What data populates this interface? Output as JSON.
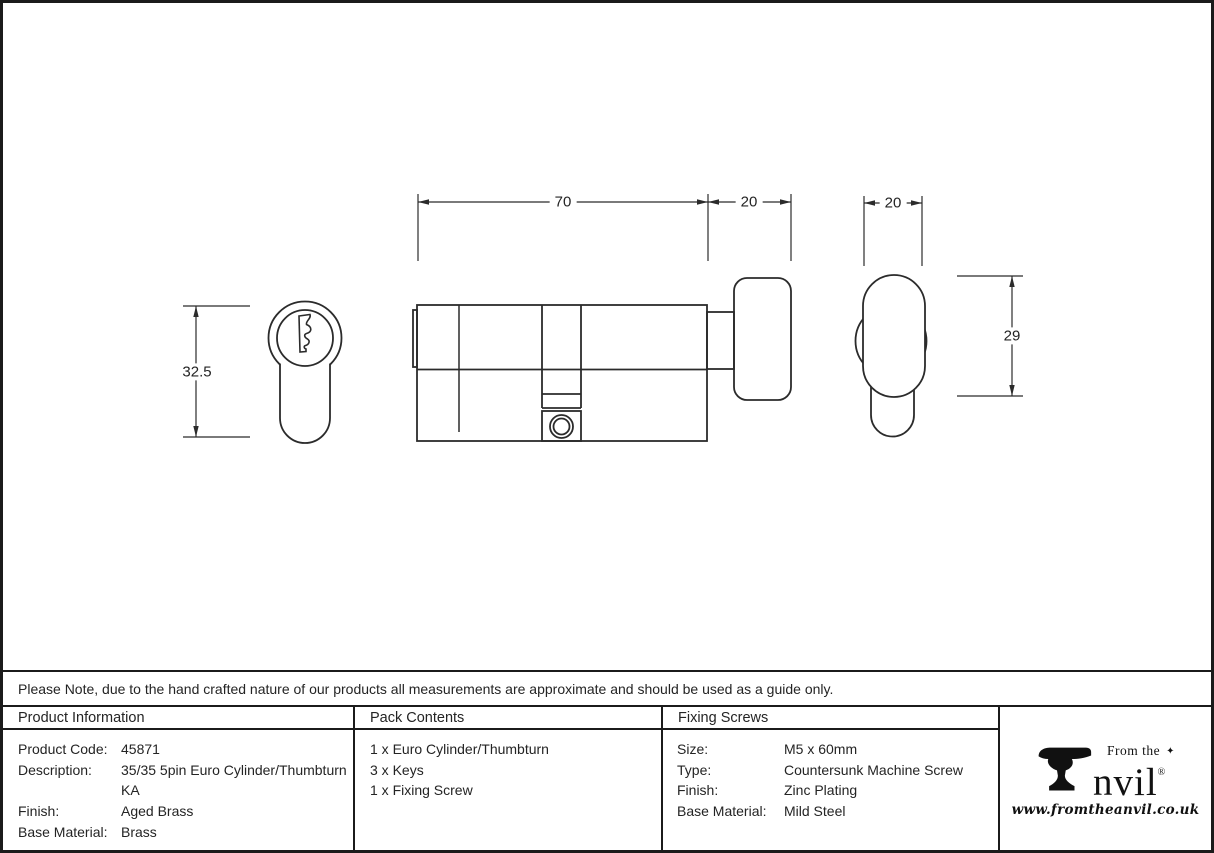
{
  "ink": "#242424",
  "drawing": {
    "dims": {
      "body_length": "70",
      "knob_length_side": "20",
      "knob_width_rear": "20",
      "front_height": "32.5",
      "rear_height": "29"
    }
  },
  "note": {
    "text": "Please Note, due to the hand crafted nature of our products all measurements are approximate and should be used as a guide only."
  },
  "table": {
    "product_information": {
      "header": "Product Information",
      "rows": [
        {
          "label": "Product Code:",
          "value": "45871"
        },
        {
          "label": "Description:",
          "value": "35/35 5pin Euro Cylinder/Thumbturn KA"
        },
        {
          "label": "Finish:",
          "value": "Aged Brass"
        },
        {
          "label": "Base Material:",
          "value": "Brass"
        }
      ]
    },
    "pack_contents": {
      "header": "Pack Contents",
      "items": [
        "1 x Euro Cylinder/Thumbturn",
        "3 x Keys",
        "1 x Fixing Screw"
      ]
    },
    "fixing_screws": {
      "header": "Fixing Screws",
      "rows": [
        {
          "label": "Size:",
          "value": "M5 x 60mm"
        },
        {
          "label": "Type:",
          "value": "Countersunk Machine Screw"
        },
        {
          "label": "Finish:",
          "value": "Zinc Plating"
        },
        {
          "label": "Base Material:",
          "value": "Mild Steel"
        }
      ]
    }
  },
  "logo": {
    "tagline": "From the",
    "star": "✦",
    "brand": "Anvil",
    "brand_rest": "nvil",
    "registered": "®",
    "url": "www.fromtheanvil.co.uk"
  }
}
